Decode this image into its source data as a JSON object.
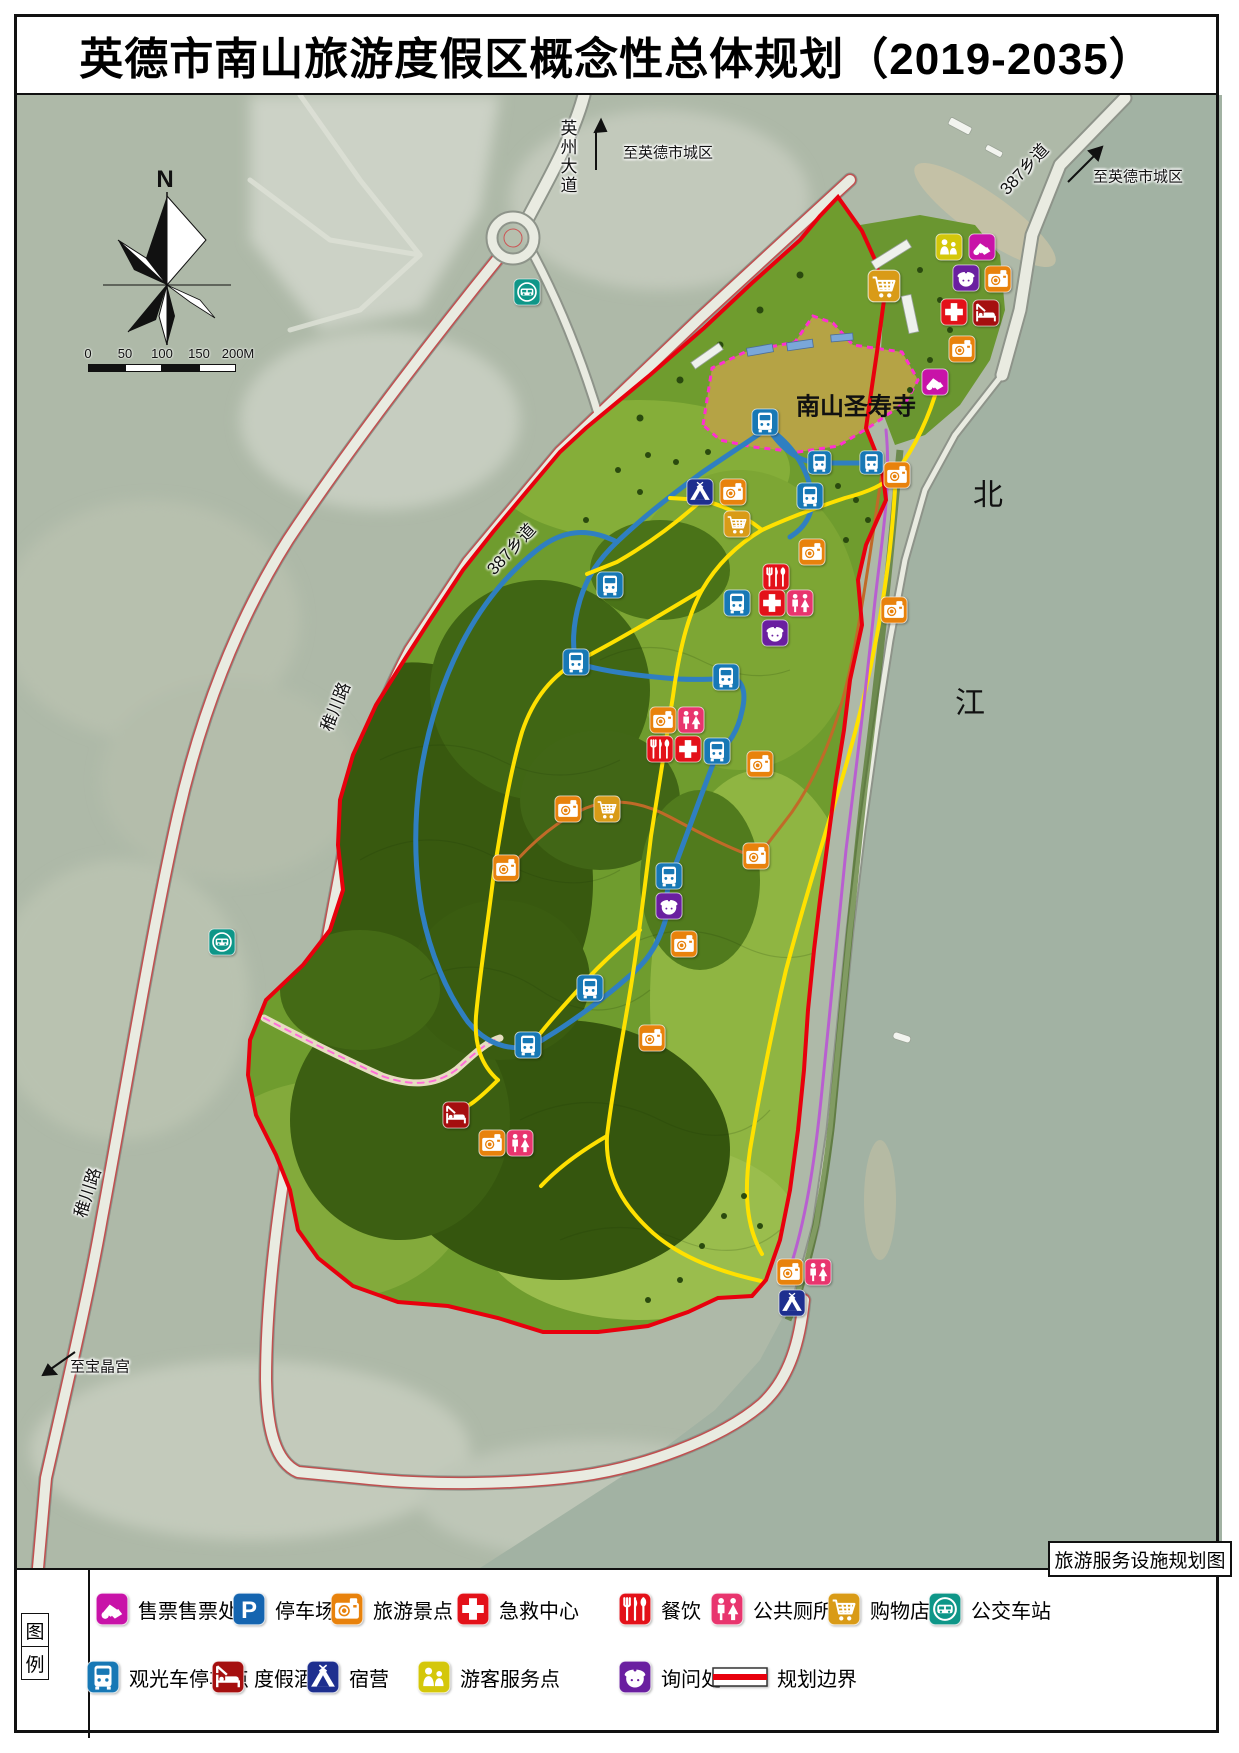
{
  "title": "英德市南山旅游度假区概念性总体规划（2019-2035）",
  "map": {
    "corner_label": "旅游服务设施规划图",
    "temple_label": "南山圣寿寺",
    "labels": [
      {
        "text": "N",
        "x": 165,
        "y": 180,
        "size": 24,
        "bold": true
      },
      {
        "text": "英州大道",
        "x": 567,
        "y": 157,
        "size": 17,
        "vertical": true,
        "halo": true
      },
      {
        "text": "至英德市城区",
        "x": 668,
        "y": 152,
        "size": 15,
        "halo": true
      },
      {
        "text": "387乡道",
        "x": 1023,
        "y": 168,
        "size": 17,
        "rotate": -47,
        "halo": true
      },
      {
        "text": "至英德市城区",
        "x": 1138,
        "y": 176,
        "size": 15,
        "halo": true
      },
      {
        "text": "南山圣寿寺",
        "x": 856,
        "y": 404,
        "size": 24,
        "bold": true
      },
      {
        "text": "387乡道",
        "x": 510,
        "y": 548,
        "size": 17,
        "rotate": -47,
        "halo": true
      },
      {
        "text": "稚川路",
        "x": 334,
        "y": 706,
        "size": 17,
        "rotate": -68,
        "halo": true
      },
      {
        "text": "北",
        "x": 988,
        "y": 492,
        "size": 30
      },
      {
        "text": "江",
        "x": 970,
        "y": 700,
        "size": 30
      },
      {
        "text": "稚川路",
        "x": 86,
        "y": 1192,
        "size": 17,
        "rotate": -72,
        "halo": true
      },
      {
        "text": "至宝晶宫",
        "x": 100,
        "y": 1366,
        "size": 15,
        "halo": true
      }
    ],
    "scalebar": {
      "ticks": [
        {
          "label": "0",
          "x": 88
        },
        {
          "label": "50",
          "x": 125
        },
        {
          "label": "100",
          "x": 162
        },
        {
          "label": "150",
          "x": 199
        },
        {
          "label": "200M",
          "x": 238
        }
      ],
      "bar": {
        "x": 88,
        "y": 364,
        "segment_width": 37,
        "segments": 4,
        "height": 8
      }
    },
    "markers": [
      {
        "t": "shopping",
        "x": 884,
        "y": 286,
        "s": 34
      },
      {
        "t": "visitor-service",
        "x": 949,
        "y": 247
      },
      {
        "t": "ticket-office",
        "x": 982,
        "y": 247
      },
      {
        "t": "information",
        "x": 966,
        "y": 278
      },
      {
        "t": "attraction",
        "x": 998,
        "y": 279
      },
      {
        "t": "first-aid",
        "x": 954,
        "y": 312
      },
      {
        "t": "resort-hotel",
        "x": 986,
        "y": 313
      },
      {
        "t": "attraction",
        "x": 962,
        "y": 349
      },
      {
        "t": "ticket-office",
        "x": 935,
        "y": 382
      },
      {
        "t": "sightseeing-bus",
        "x": 819,
        "y": 462,
        "s": 25
      },
      {
        "t": "sightseeing-bus",
        "x": 871,
        "y": 462,
        "s": 25
      },
      {
        "t": "attraction",
        "x": 897,
        "y": 475
      },
      {
        "t": "sightseeing-bus",
        "x": 765,
        "y": 422
      },
      {
        "t": "camping",
        "x": 700,
        "y": 492
      },
      {
        "t": "attraction",
        "x": 733,
        "y": 492
      },
      {
        "t": "shopping",
        "x": 737,
        "y": 524
      },
      {
        "t": "sightseeing-bus",
        "x": 810,
        "y": 496
      },
      {
        "t": "attraction",
        "x": 812,
        "y": 552
      },
      {
        "t": "dining",
        "x": 776,
        "y": 577
      },
      {
        "t": "sightseeing-bus",
        "x": 737,
        "y": 603
      },
      {
        "t": "first-aid",
        "x": 772,
        "y": 603
      },
      {
        "t": "toilet",
        "x": 800,
        "y": 603
      },
      {
        "t": "information",
        "x": 775,
        "y": 633
      },
      {
        "t": "sightseeing-bus",
        "x": 610,
        "y": 585
      },
      {
        "t": "sightseeing-bus",
        "x": 576,
        "y": 662
      },
      {
        "t": "sightseeing-bus",
        "x": 726,
        "y": 677
      },
      {
        "t": "attraction",
        "x": 894,
        "y": 610
      },
      {
        "t": "attraction",
        "x": 663,
        "y": 720
      },
      {
        "t": "toilet",
        "x": 691,
        "y": 720
      },
      {
        "t": "dining",
        "x": 660,
        "y": 749
      },
      {
        "t": "first-aid",
        "x": 688,
        "y": 749
      },
      {
        "t": "sightseeing-bus",
        "x": 717,
        "y": 751
      },
      {
        "t": "attraction",
        "x": 760,
        "y": 764
      },
      {
        "t": "attraction",
        "x": 568,
        "y": 809
      },
      {
        "t": "shopping",
        "x": 607,
        "y": 809
      },
      {
        "t": "attraction",
        "x": 756,
        "y": 856
      },
      {
        "t": "attraction",
        "x": 506,
        "y": 868
      },
      {
        "t": "sightseeing-bus",
        "x": 669,
        "y": 876
      },
      {
        "t": "information",
        "x": 669,
        "y": 906
      },
      {
        "t": "attraction",
        "x": 684,
        "y": 944
      },
      {
        "t": "sightseeing-bus",
        "x": 590,
        "y": 988
      },
      {
        "t": "attraction",
        "x": 652,
        "y": 1038
      },
      {
        "t": "sightseeing-bus",
        "x": 528,
        "y": 1045
      },
      {
        "t": "resort-hotel",
        "x": 456,
        "y": 1115
      },
      {
        "t": "attraction",
        "x": 492,
        "y": 1143
      },
      {
        "t": "toilet",
        "x": 520,
        "y": 1143
      },
      {
        "t": "attraction",
        "x": 790,
        "y": 1272
      },
      {
        "t": "toilet",
        "x": 818,
        "y": 1272
      },
      {
        "t": "camping",
        "x": 792,
        "y": 1303
      },
      {
        "t": "bus-station",
        "x": 527,
        "y": 292
      },
      {
        "t": "bus-station",
        "x": 222,
        "y": 942
      }
    ]
  },
  "legend": {
    "heading": [
      "图",
      "例"
    ],
    "icon_colors": {
      "ticket-office": "#C813A8",
      "parking": "#1565B0",
      "attraction": "#E8820C",
      "first-aid": "#E31119",
      "dining": "#E31119",
      "toilet": "#E8356E",
      "shopping": "#D99B17",
      "bus-station": "#0E9688",
      "sightseeing-bus": "#1778B5",
      "resort-hotel": "#A50F0F",
      "camping": "#1E2F8F",
      "visitor-service": "#D4C70A",
      "information": "#6A1FA0",
      "boundary": "#E8000D"
    },
    "rows": [
      {
        "y": 1590,
        "items": [
          {
            "t": "ticket-office",
            "label": "售票售票处",
            "x": 95
          },
          {
            "t": "parking",
            "label": "停车场",
            "x": 232
          },
          {
            "t": "attraction",
            "label": "旅游景点",
            "x": 330
          },
          {
            "t": "first-aid",
            "label": "急救中心",
            "x": 456
          },
          {
            "t": "dining",
            "label": "餐饮",
            "x": 618
          },
          {
            "t": "toilet",
            "label": "公共厕所",
            "x": 710
          },
          {
            "t": "shopping",
            "label": "购物店",
            "x": 827
          },
          {
            "t": "bus-station",
            "label": "公交车站",
            "x": 928
          }
        ]
      },
      {
        "y": 1658,
        "items": [
          {
            "t": "sightseeing-bus",
            "label": "观光车停车点",
            "x": 86
          },
          {
            "t": "resort-hotel",
            "label": "度假酒店",
            "x": 211
          },
          {
            "t": "camping",
            "label": "宿营",
            "x": 306
          },
          {
            "t": "visitor-service",
            "label": "游客服务点",
            "x": 417
          },
          {
            "t": "information",
            "label": "询问处",
            "x": 618
          },
          {
            "t": "boundary",
            "label": "规划边界",
            "x": 712
          }
        ]
      }
    ]
  },
  "colors": {
    "boundary_red": "#E8000D",
    "route_yellow": "#FFE100",
    "route_blue": "#2F7FC1",
    "route_purple": "#B85FD0",
    "route_brown": "#C06A28",
    "temple_dash_pink": "#FF2FD0",
    "river": "#A2B2A3",
    "land": "#AEB9A8",
    "resort_green": "#6F9C2E",
    "temple_fill": "#B5A345"
  }
}
